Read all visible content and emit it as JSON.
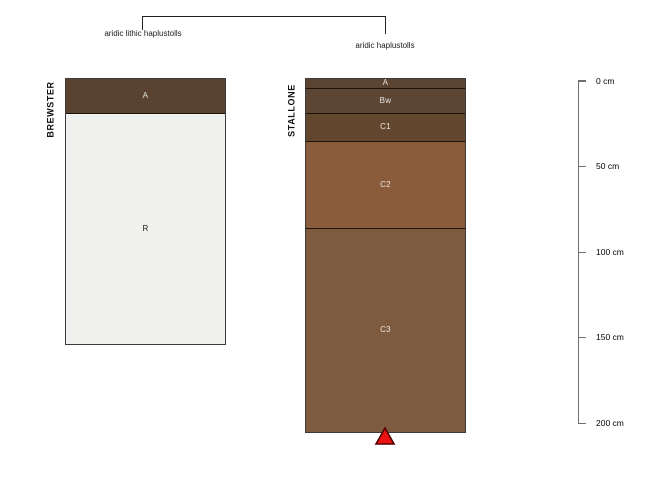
{
  "annotations": {
    "left_label": "aridic lithic haplustolls",
    "right_label": "aridic haplustolls"
  },
  "profiles": [
    {
      "name": "BREWSTER",
      "classification": "aridic lithic haplustolls",
      "horizons": [
        {
          "label": "A",
          "top_cm": 0,
          "bottom_cm": 20,
          "color": "#59422F",
          "text_color": "#EAE6E1"
        },
        {
          "label": "R",
          "top_cm": 20,
          "bottom_cm": 155,
          "color": "#F0F0EE",
          "text_color": "#1A1A1A"
        }
      ]
    },
    {
      "name": "STALLONE",
      "classification": "aridic haplustolls",
      "horizons": [
        {
          "label": "A",
          "top_cm": 0,
          "bottom_cm": 5,
          "color": "#5A4330",
          "text_color": "#EAE6E1"
        },
        {
          "label": "Bw",
          "top_cm": 5,
          "bottom_cm": 20,
          "color": "#5D4634",
          "text_color": "#EAE6E1"
        },
        {
          "label": "C1",
          "top_cm": 20,
          "bottom_cm": 36,
          "color": "#63462E",
          "text_color": "#EAE6E1"
        },
        {
          "label": "C2",
          "top_cm": 36,
          "bottom_cm": 87,
          "color": "#8A5C3B",
          "text_color": "#EAE6E1"
        },
        {
          "label": "C3",
          "top_cm": 87,
          "bottom_cm": 206,
          "color": "#7E5B3F",
          "text_color": "#EAE6E1"
        }
      ],
      "marker": {
        "shape": "triangle-up",
        "fill": "#EE1111",
        "stroke": "#550000"
      }
    }
  ],
  "depth_scale": {
    "unit": "cm",
    "ticks": [
      {
        "value": 0,
        "label": "0 cm"
      },
      {
        "value": 50,
        "label": "50 cm"
      },
      {
        "value": 100,
        "label": "100 cm"
      },
      {
        "value": 150,
        "label": "150 cm"
      },
      {
        "value": 200,
        "label": "200 cm"
      }
    ]
  },
  "style": {
    "separator_color": "#1D1309",
    "bracket_color": "#222222",
    "scale_color": "#6F6F6F"
  }
}
